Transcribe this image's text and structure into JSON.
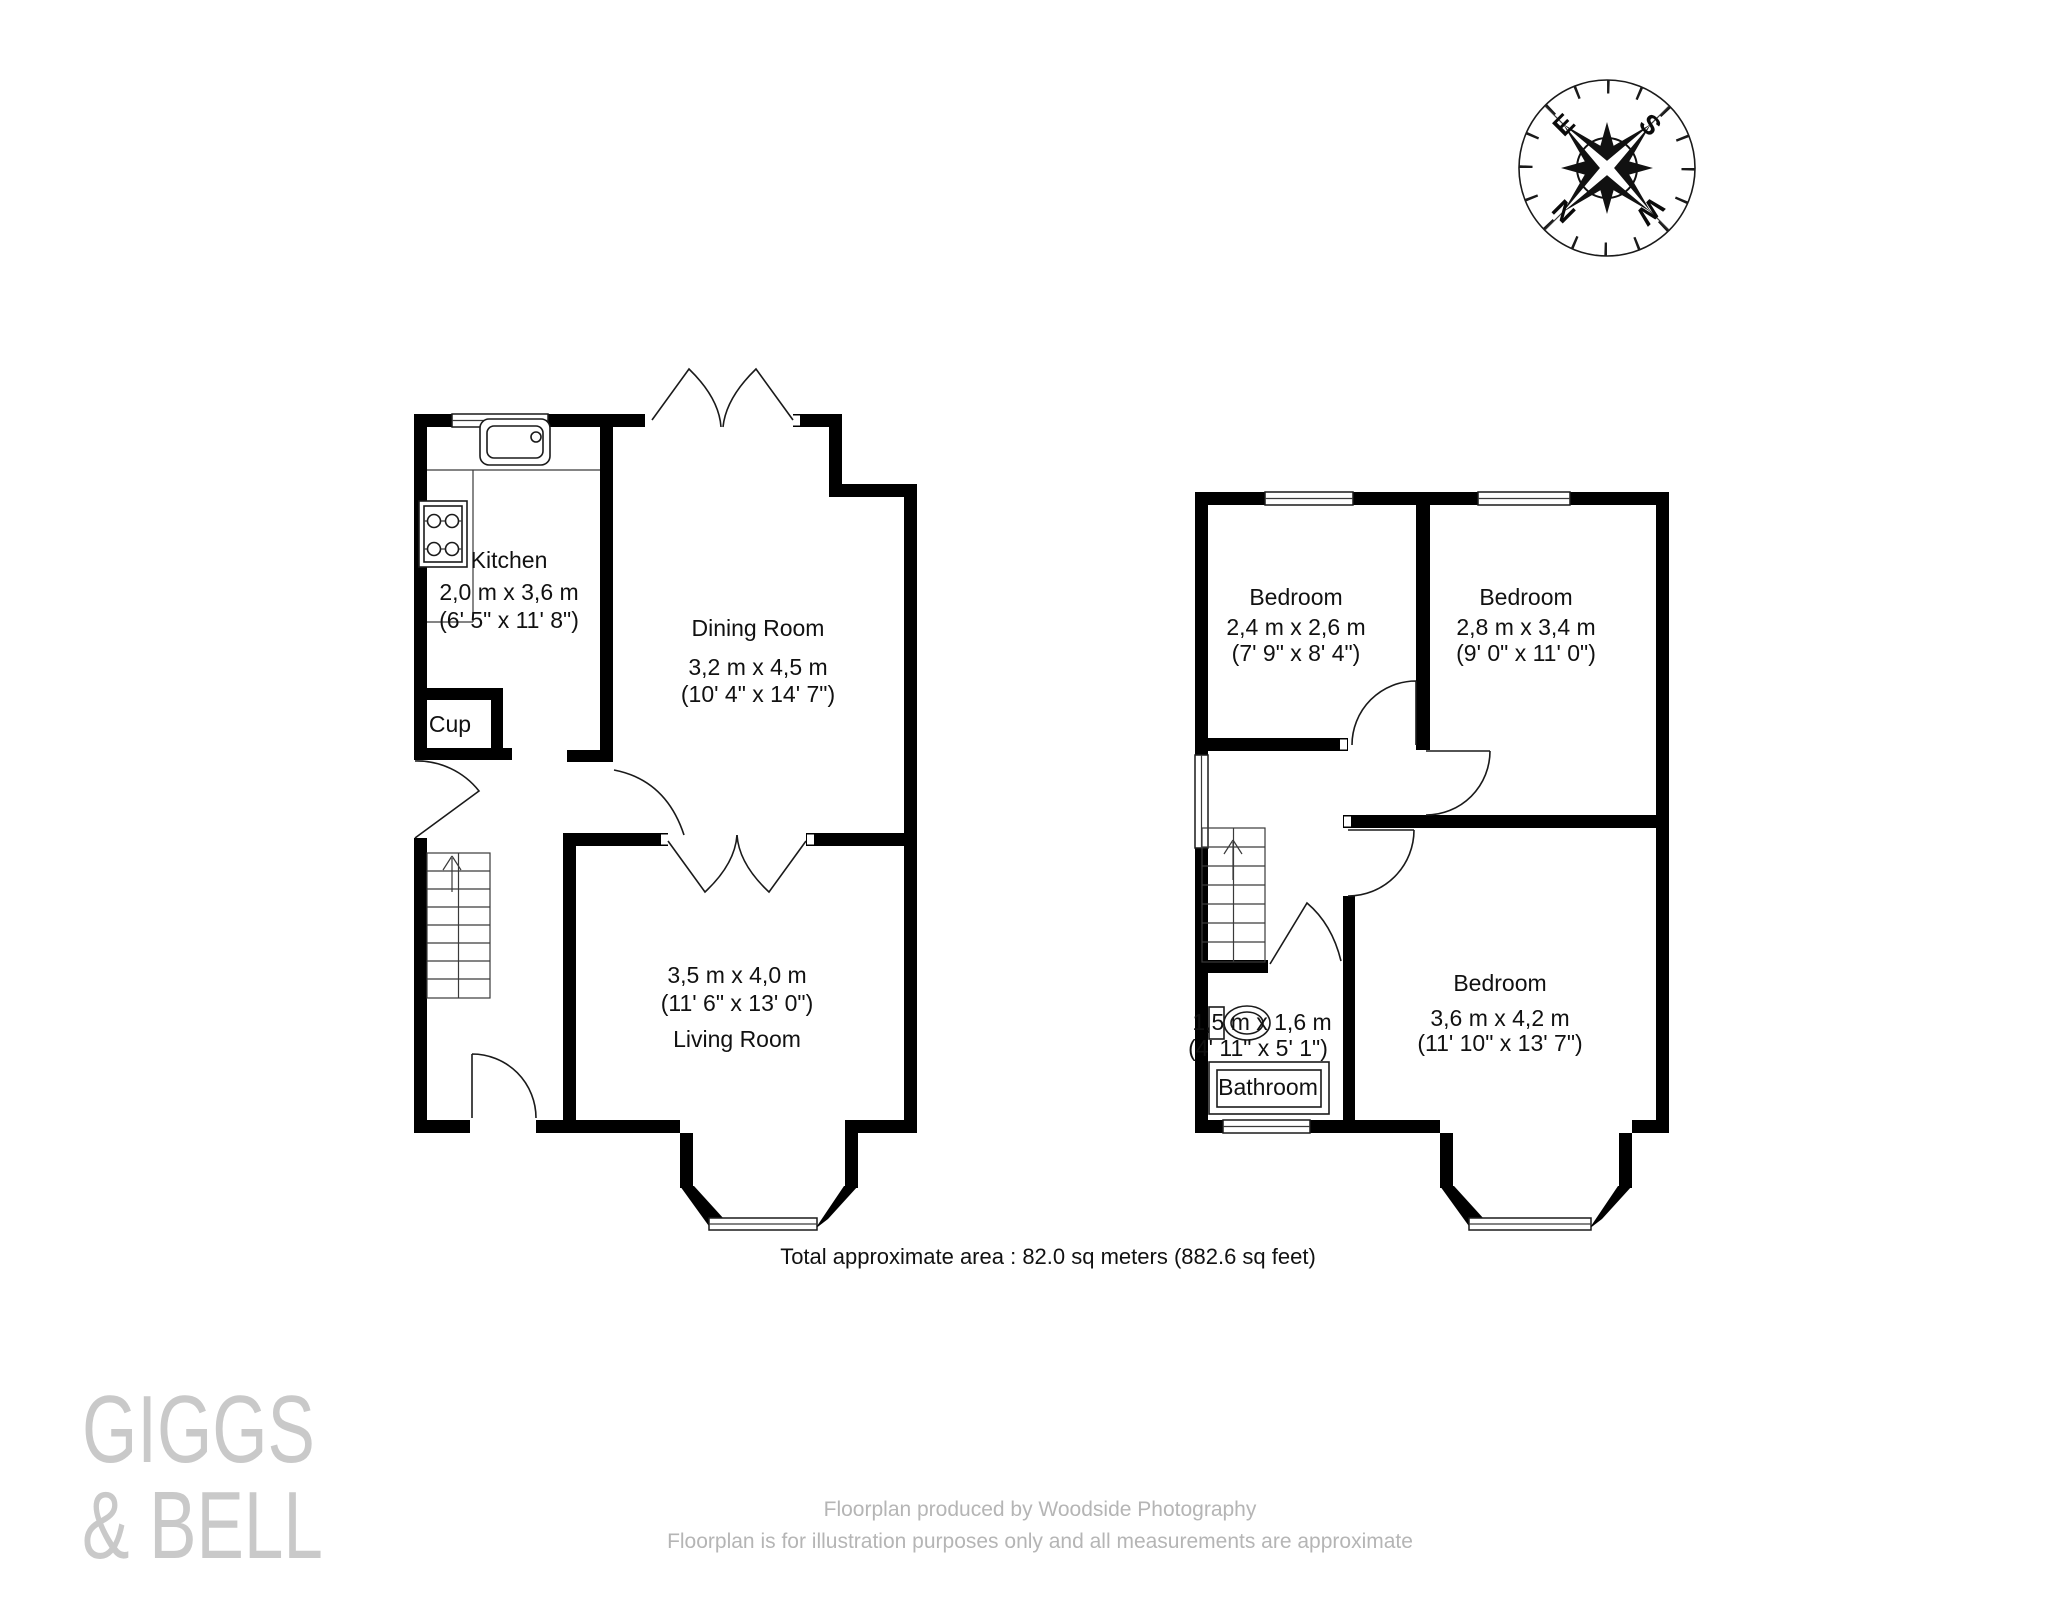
{
  "ground_floor": {
    "kitchen": {
      "name": "Kitchen",
      "size_metric": "2,0 m x 3,6 m",
      "size_imperial": "(6' 5\" x 11' 8\")"
    },
    "cupboard": {
      "name": "Cup"
    },
    "dining_room": {
      "name": "Dining Room",
      "size_metric": "3,2 m x 4,5 m",
      "size_imperial": "(10' 4\" x 14' 7\")"
    },
    "living_room": {
      "name": "Living Room",
      "size_metric": "3,5 m x 4,0 m",
      "size_imperial": "(11' 6\" x 13' 0\")"
    }
  },
  "first_floor": {
    "bedroom_front_left": {
      "name": "Bedroom",
      "size_metric": "2,4 m x 2,6 m",
      "size_imperial": "(7' 9\" x 8' 4\")"
    },
    "bedroom_front_right": {
      "name": "Bedroom",
      "size_metric": "2,8 m x 3,4 m",
      "size_imperial": "(9' 0\" x 11' 0\")"
    },
    "bedroom_rear": {
      "name": "Bedroom",
      "size_metric": "3,6 m x 4,2 m",
      "size_imperial": "(11' 10\" x 13' 7\")"
    },
    "bathroom": {
      "name": "Bathroom",
      "size_metric": "1,5 m x 1,6 m",
      "size_imperial": "(4' 11\" x 5' 1\")"
    }
  },
  "total_area_label": "Total approximate area : 82.0 sq meters (882.6 sq feet)",
  "compass": {
    "north": "N",
    "east": "E",
    "south": "S",
    "west": "W"
  },
  "branding": {
    "agent_line1": "GIGGS",
    "agent_line2": "& BELL"
  },
  "footer": {
    "line1": "Floorplan produced by Woodside Photography",
    "line2": "Floorplan is for illustration purposes only and all measurements are approximate"
  },
  "colors": {
    "wall": "#000000",
    "text": "#111111",
    "watermark": "#c9c9c9",
    "footer_text": "#b5b5b5"
  }
}
